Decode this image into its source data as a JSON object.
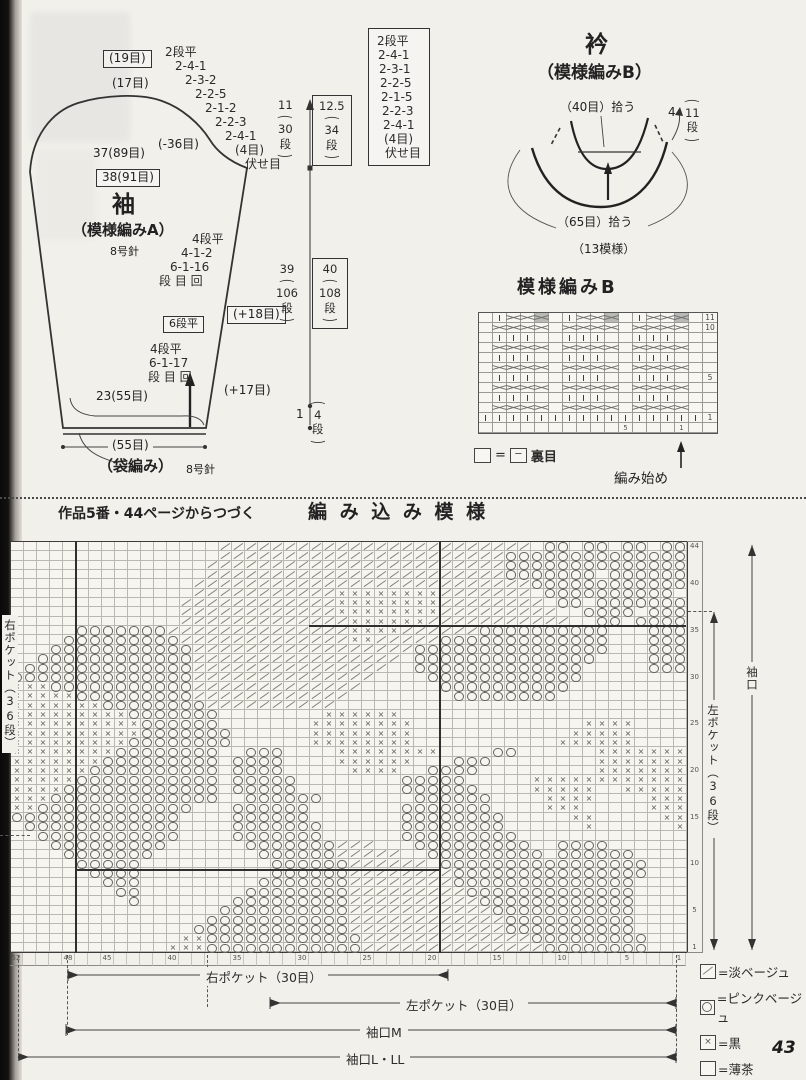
{
  "page": {
    "number": "43",
    "continuation": "作品5番・44ページからつづく"
  },
  "sleeve": {
    "title": "袖",
    "subtitle": "（模様編みA）",
    "needle": "8号針",
    "sts_19": "(19目)",
    "sts_17": "(17目)",
    "cap_decreases": [
      "2段平",
      "2-4-1",
      "2-3-2",
      "2-2-5",
      "2-1-2",
      "2-2-3",
      "2-4-1",
      "(4目)",
      "伏せ目"
    ],
    "width_37": "37(89目)",
    "minus36": "(-36目)",
    "width_38": "38(91目)",
    "inc1": [
      "4段平",
      "4-1-2",
      "6-1-16",
      "段 目 回"
    ],
    "flat6": "6段平",
    "inc2": [
      "4段平",
      "6-1-17",
      "段 目 回"
    ],
    "plus18": "(+18目)",
    "plus17": "(+17目)",
    "cuff_width": "23(55目)",
    "cuff_sts": "(55目)",
    "cuff_note": "（袋編み）",
    "cuff_needle": "8号針",
    "cap_dim": {
      "cm": "11",
      "rows": "30",
      "unit": "段"
    },
    "cap_dim_boxed": {
      "cm": "12.5",
      "rows": "34",
      "unit": "段"
    },
    "len_dim": {
      "cm": "39",
      "rows": "106",
      "unit": "段"
    },
    "len_dim_boxed": {
      "cm": "40",
      "rows": "108",
      "unit": "段"
    },
    "hem_dim": {
      "cm": "1",
      "rows": "4",
      "unit": "段"
    },
    "paren_open": "(",
    "paren_close": ")"
  },
  "collar": {
    "title": "衿",
    "subtitle": "（模様編みB）",
    "pickup_top": "（40目）拾う",
    "side_cm": "4",
    "side_rows": "11",
    "side_unit": "段",
    "pickup_bottom": "（65目）拾う",
    "patterns": "（13模様）",
    "decreases": [
      "2段平",
      "2-4-1",
      "2-3-1",
      "2-2-5",
      "2-1-5",
      "2-2-3",
      "2-4-1",
      "(4目)",
      "伏せ目"
    ]
  },
  "patternB": {
    "title": "模様編みB",
    "rows": [
      ".izz#.izz#.izz#.",
      ".zzzz.zzzz.zzzz.",
      ".iii..iii..iii..",
      ".zzzz.zzzz.zzzz.",
      ".iii..iii..iii..",
      ".zzzz.zzzz.zzzz.",
      ".iii..iii..iii..",
      ".zzzz.zzzz.zzzz.",
      ".iii..iii..iii..",
      ".zzzz.zzzz.zzzz.",
      "iiiiiiiiiiiiiiii",
      "................"
    ],
    "row_labels": [
      "11",
      "10",
      "",
      "",
      "",
      "",
      "5",
      "",
      "",
      "",
      "1",
      ""
    ],
    "bottom_labels": [
      "",
      "",
      "",
      "",
      "",
      "",
      "",
      "",
      "",
      "",
      "5",
      "",
      "",
      "",
      "1",
      ""
    ],
    "purl_legend": {
      "sym1": "",
      "eq": "=",
      "sym2": "─",
      "label": "裏目"
    },
    "start_label": "編み始め"
  },
  "big_chart": {
    "type": "colorwork-grid",
    "heading": "作品5番・44ページからつづく",
    "title": "編 み 込 み 模 様",
    "symbols": {
      ".": "薄茶",
      "/": "淡ベージュ",
      "x": "黒",
      "o": "ピンクベージュ"
    },
    "rows": [
      "................////////////////////////.oo.oo.oo.oo",
      "................//////////////////////oooooooooooooo",
      "...............///////////////////////oooooooooooooo",
      "...............///////////////////////ooooooo.oooooo",
      "..............//////////////////////////oooooooooooo",
      "..............///////////xxxxxxxx///////.oooooooooo.",
      ".............////////////xxxxxxxx////////.oo.ooooooo",
      ".............////////////xxxxxxxx/////////..oooo.ooo",
      "............./////////////xxxxxx///////////..oo.ooooo",
      ".....ooooooo//////////////xxxx//////oooooooooo...ooo",
      "....ooooooooo/////////////xx/////ooooooooooooo...ooo",
      "...ooooooooooo/////////////////ooooooooooooooo...ooo",
      "..oooooooooooo////////////////.oooooooooooooo....ooo",
      ".ooooooooooooo///////////////..ooooooooooooo.....ooo",
      "oooooooooooooo//////////////....oooooooooooo........",
      "xxxooooooooooo/////////////......oooooooooo.........",
      "xxxxxooooooooo////////////........oooooooo..........",
      "xxxxxxxoooooooo//////////...........................",
      "xxxxxxxxxooooooo........xxxxxx......................",
      "xxxxxxxxxxoooooo.......xxxxxxxx.............xxxx....",
      "xxxxxxxxxxooooooo......xxxxxxxx............xxxxx....",
      "xxxxxxxxxoooooooo......xxxxxxxx...........xxxxxx....",
      "xxxxxxxxoooooooo..ooo....xxxxxxxx....oo......xxxxxxx",
      "xxxxxxxooooooooo.oooo....xxxxxx...ooo........xxxxxxx",
      "xxxxxxoooooooooo.oooo.....xxxx..oooo.........xxxxxxx",
      "xxxxxooooooooooo.ooooo........ooooo.....xxxxxxxxxxxx",
      "xxxxoooooooooooo.ooooo........oooooo....xxxxx..xxxxx",
      "xxxooooooooooooo..oooooo.......oooooo....xxxx....xxxx",
      "xxoooooooooooo...oooooo.......ooooooo....xxx.....xxx",
      "ooooooooooooo....oooooo.......oooooooo.....xx.....xx",
      ".oooooooooooo....ooooooo......oooooooo......x......x",
      "..ooooooooooo....ooooooo......ooooooooo.............",
      "...ooooooooo......ooooooo///...ooooooooo..oooo......",
      "....ooooooo........oooooo/////..ooooooooo.oooooo....",
      ".....ooooo..........oooooo//////.oooooooooooooooo...",
      "......oooo..........oooooo////////ooooooooooooooo...",
      ".......ooo.........ooooooo////////oooooooooooooo....",
      "........oo........oooooooo/////////ooooooooooooo....",
      ".........o.......ooooooooo//////////oooooooooooo....",
      "................oooooooooo///////////ooooooooooo....",
      "...............ooooooooooo////////////oooooooooo....",
      "..............oooooooooooo////////////oooooooooo....",
      ".............xxoooooooooooo/////////////ooooooooo...",
      "............xxxoooooooooooo//////////////oooooooo..."
    ],
    "row_labels": [
      "44",
      "",
      "",
      "",
      "40",
      "",
      "",
      "",
      "",
      "35",
      "",
      "",
      "",
      "",
      "30",
      "",
      "",
      "",
      "",
      "25",
      "",
      "",
      "",
      "",
      "20",
      "",
      "",
      "",
      "",
      "15",
      "",
      "",
      "",
      "",
      "10",
      "",
      "",
      "",
      "",
      "5",
      "",
      "",
      "",
      "1"
    ],
    "col_labels": [
      "52",
      "",
      "",
      "",
      "48",
      "",
      "",
      "45",
      "",
      "",
      "",
      "",
      "40",
      "",
      "",
      "",
      "",
      "35",
      "",
      "",
      "",
      "",
      "30",
      "",
      "",
      "",
      "",
      "25",
      "",
      "",
      "",
      "",
      "20",
      "",
      "",
      "",
      "",
      "15",
      "",
      "",
      "",
      "",
      "10",
      "",
      "",
      "",
      "",
      "5",
      "",
      "",
      "",
      "1"
    ],
    "dims": {
      "right_pocket": "右ポケット（30目）",
      "left_pocket": "左ポケット（30目）",
      "cuff_m": "袖口M",
      "cuff_lll": "袖口L・LL",
      "right_pocket_rows": "右ポケット（36段）",
      "left_pocket_rows": "左ポケット（36段）",
      "cuff_side": "袖口"
    },
    "legend": [
      {
        "sym": "/",
        "label": "=淡ベージュ"
      },
      {
        "sym": "o",
        "label": "=ピンクベージュ"
      },
      {
        "sym": "x",
        "label": "=黒"
      },
      {
        "sym": ".",
        "label": "=薄茶"
      }
    ]
  }
}
